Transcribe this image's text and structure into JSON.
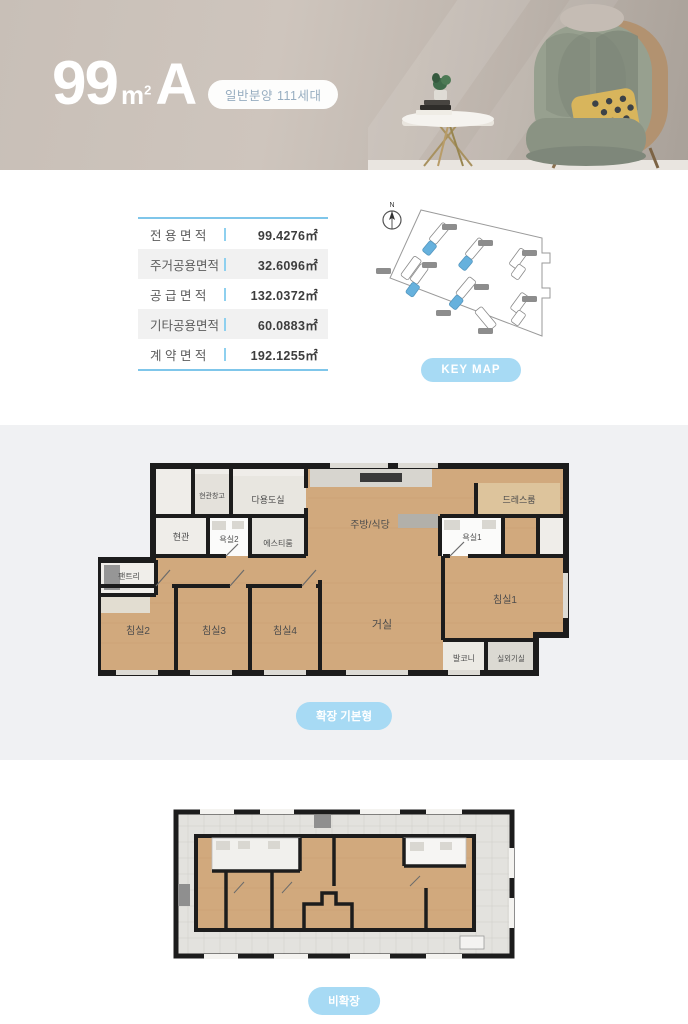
{
  "header": {
    "title_number": "99",
    "title_unit": "m",
    "title_sup": "2",
    "title_type": "A",
    "badge": "일반분양 111세대"
  },
  "area_table": {
    "rows": [
      {
        "label": "전 용 면 적",
        "value": "99.4276㎡"
      },
      {
        "label": "주거공용면적",
        "value": "32.6096㎡"
      },
      {
        "label": "공 급 면 적",
        "value": "132.0372㎡"
      },
      {
        "label": "기타공용면적",
        "value": "60.0883㎡"
      },
      {
        "label": "계 약 면 적",
        "value": "192.1255㎡"
      }
    ]
  },
  "keymap": {
    "compass": "N",
    "button": "KEY MAP"
  },
  "floorplan_expanded": {
    "button": "확장 기본형",
    "rooms": {
      "entry_storage": "현관창고",
      "utility": "다용도실",
      "entry": "현관",
      "bath2": "욕실2",
      "st_room": "에스티룸",
      "kitchen": "주방/식당",
      "dress": "드레스룸",
      "bath1": "욕실1",
      "pantry": "팬트리",
      "bed2": "침실2",
      "bed3": "침실3",
      "bed4": "침실4",
      "living": "거실",
      "bed1": "침실1",
      "balcony": "발코니",
      "ac_room": "실외기실"
    }
  },
  "floorplan_basic": {
    "button": "비확장"
  },
  "colors": {
    "accent_blue": "#a7daf4",
    "table_border_blue": "#7fc6ea",
    "keymap_highlight": "#66b1dd",
    "wood_floor": "#d1a97d",
    "wall": "#1c1c1c",
    "hero_background": "#c8bfb7"
  }
}
